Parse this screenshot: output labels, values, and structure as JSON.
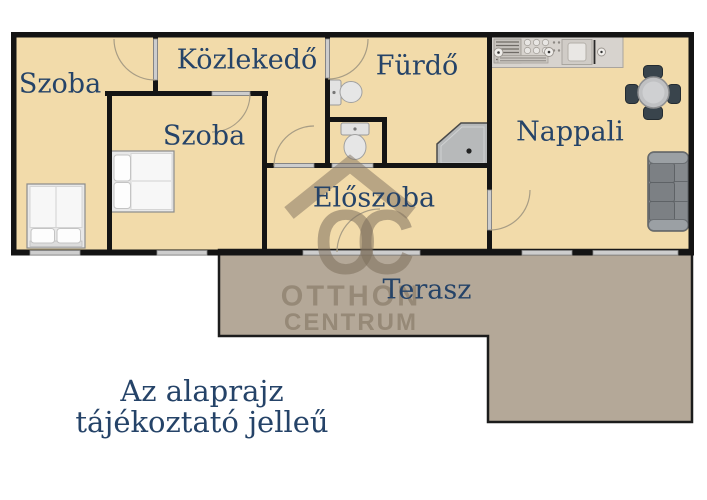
{
  "floorplan": {
    "rooms": [
      {
        "id": "szoba-1",
        "label": "Szoba"
      },
      {
        "id": "kozlekedo",
        "label": "Közlekedő"
      },
      {
        "id": "furdo",
        "label": "Fürdő"
      },
      {
        "id": "szoba-2",
        "label": "Szoba"
      },
      {
        "id": "nappali",
        "label": "Nappali"
      },
      {
        "id": "eloszoba",
        "label": "Előszoba"
      },
      {
        "id": "terasz",
        "label": "Terasz"
      }
    ],
    "furniture_icons": [
      "double-bed-icon",
      "double-bed-icon",
      "toilet-icon",
      "toilet-icon",
      "shower-icon",
      "kitchen-counter-icon",
      "dining-table-icon",
      "sofa-icon"
    ],
    "disclaimer": {
      "line1": "Az alaprajz",
      "line2": "tájékoztató jelleű"
    },
    "watermark": {
      "monogram": "OC",
      "name_line1": "OTTHON",
      "name_line2": "CENTRUM"
    },
    "colors": {
      "floor": "#f2dbaa",
      "terrace": "#b4a898",
      "wall": "#141414",
      "label_text": "#254368",
      "watermark": "#7d705c",
      "window_gray": "#cdcdcd"
    }
  }
}
